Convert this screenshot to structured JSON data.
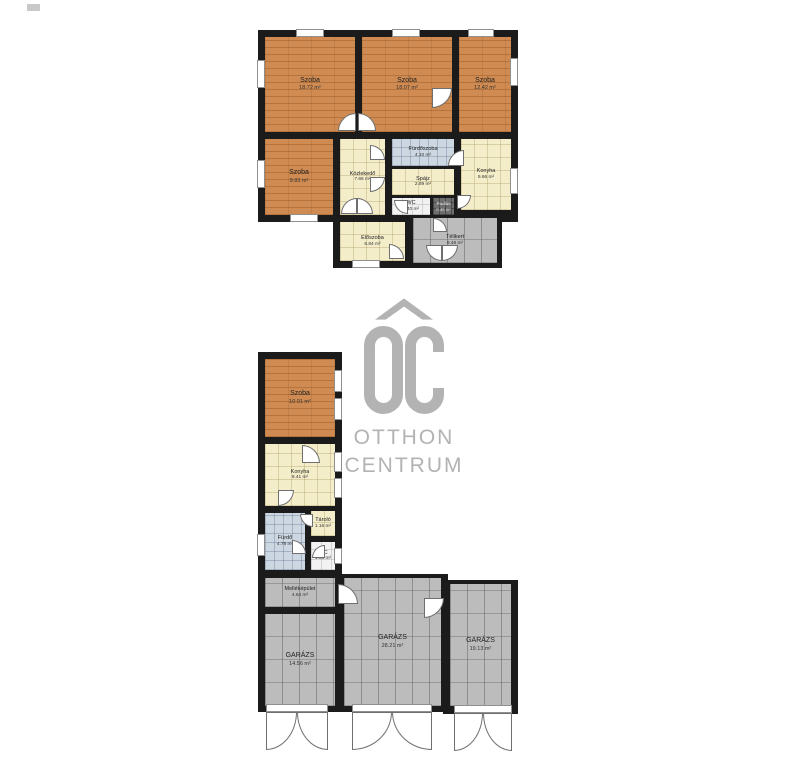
{
  "watermark": {
    "monogram": "OC",
    "line1": "OTTHON",
    "line2": "CENTRUM",
    "color": "#b3b3b3"
  },
  "colors": {
    "wall": "#1b1b1b",
    "wood_floor": "#cf8b51",
    "cream_tile": "#f4edca",
    "blue_tile": "#cdd7e1",
    "gray_tile": "#bcbcbc",
    "white_tile": "#f2f2f2"
  },
  "plans": [
    {
      "id": "main-house",
      "rooms": [
        {
          "name": "Szoba",
          "area": "18.72 m²",
          "floor": "wood"
        },
        {
          "name": "Szoba",
          "area": "18.07 m²",
          "floor": "wood"
        },
        {
          "name": "Szoba",
          "area": "12.42 m²",
          "floor": "wood"
        },
        {
          "name": "Szoba",
          "area": "9.93 m²",
          "floor": "wood"
        },
        {
          "name": "Közlekedő",
          "area": "7.66 m²",
          "floor": "cream-tile"
        },
        {
          "name": "Fürdőszoba",
          "area": "4.10 m²",
          "floor": "blue-tile"
        },
        {
          "name": "Spájz",
          "area": "2.89 m²",
          "floor": "cream-tile"
        },
        {
          "name": "Konyha",
          "area": "9.66 m²",
          "floor": "cream-tile"
        },
        {
          "name": "WC",
          "area": "1.40 m²",
          "floor": "white-tile"
        },
        {
          "name": "Padlás",
          "area": "0.46 m²",
          "floor": "dark-tile"
        },
        {
          "name": "Előszoba",
          "area": "6.84 m²",
          "floor": "cream-tile"
        },
        {
          "name": "Télikert",
          "area": "9.48 m²",
          "floor": "gray-tile"
        }
      ]
    },
    {
      "id": "outbuilding-and-garages",
      "rooms": [
        {
          "name": "Szoba",
          "area": "10.01 m²",
          "floor": "wood"
        },
        {
          "name": "Konyha",
          "area": "8.41 m²",
          "floor": "cream-tile"
        },
        {
          "name": "Tároló",
          "area": "1.16 m²",
          "floor": "cream-tile"
        },
        {
          "name": "Fürdő",
          "area": "4.78 m²",
          "floor": "blue-tile"
        },
        {
          "name": "WC",
          "area": "1.05 m²",
          "floor": "white-tile"
        },
        {
          "name": "Melléképület",
          "area": "4.64 m²",
          "floor": "gray-tile"
        },
        {
          "name": "GARÁZS",
          "area": "14.56 m²",
          "floor": "gray-tile"
        },
        {
          "name": "GARÁZS",
          "area": "28.21 m²",
          "floor": "gray-tile"
        },
        {
          "name": "GARÁZS",
          "area": "19.13 m²",
          "floor": "gray-tile"
        }
      ]
    }
  ]
}
